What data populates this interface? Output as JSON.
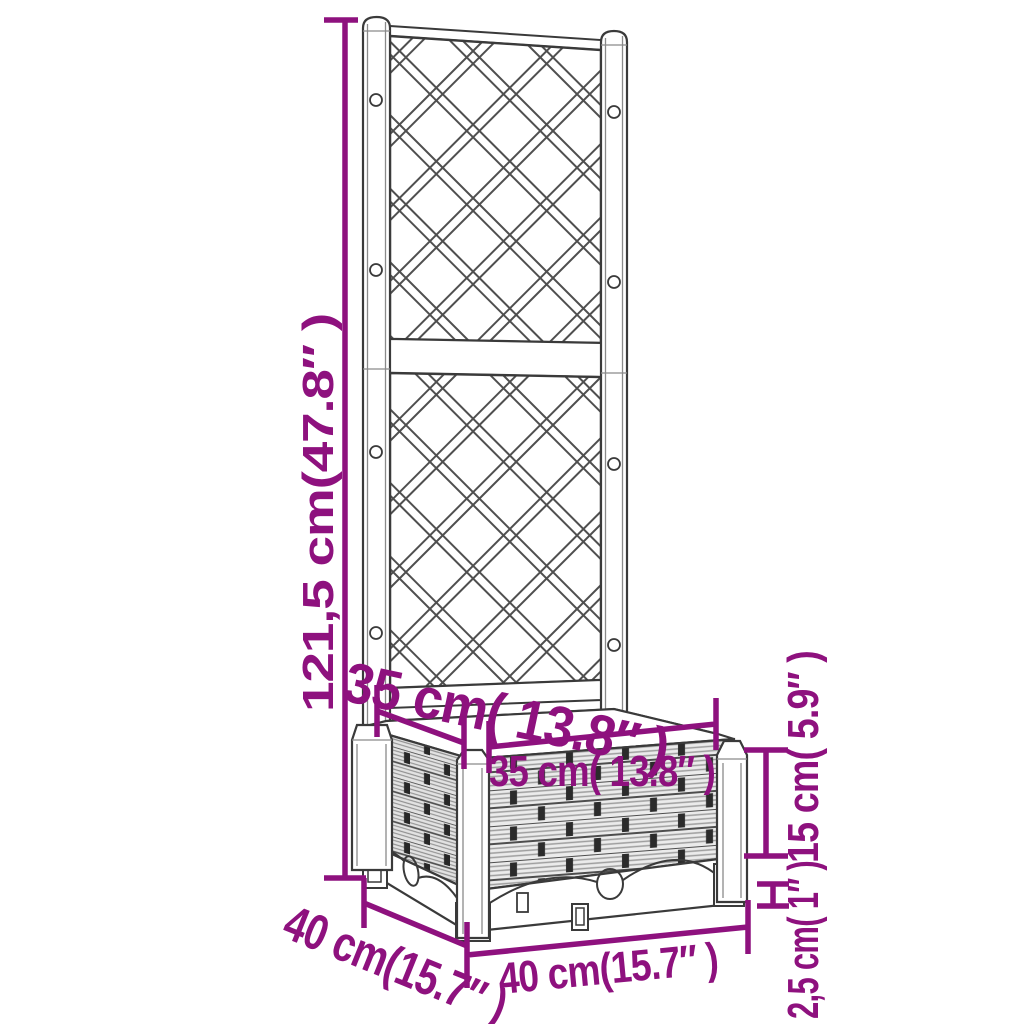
{
  "colors": {
    "accent": "#8E117E",
    "linework": "#3a3a3a",
    "background": "#ffffff"
  },
  "labels": {
    "total_height": "121,5 cm(47.8″ )",
    "inner_depth": "35 cm( 13.8″ )",
    "inner_width": "35 cm( 13.8″ )",
    "box_height": "15 cm( 5.9″ )",
    "foot_height": "2,5 cm( 1″ )",
    "outer_width": "40 cm(15.7″ )",
    "outer_depth": "40 cm(15.7″ )"
  }
}
